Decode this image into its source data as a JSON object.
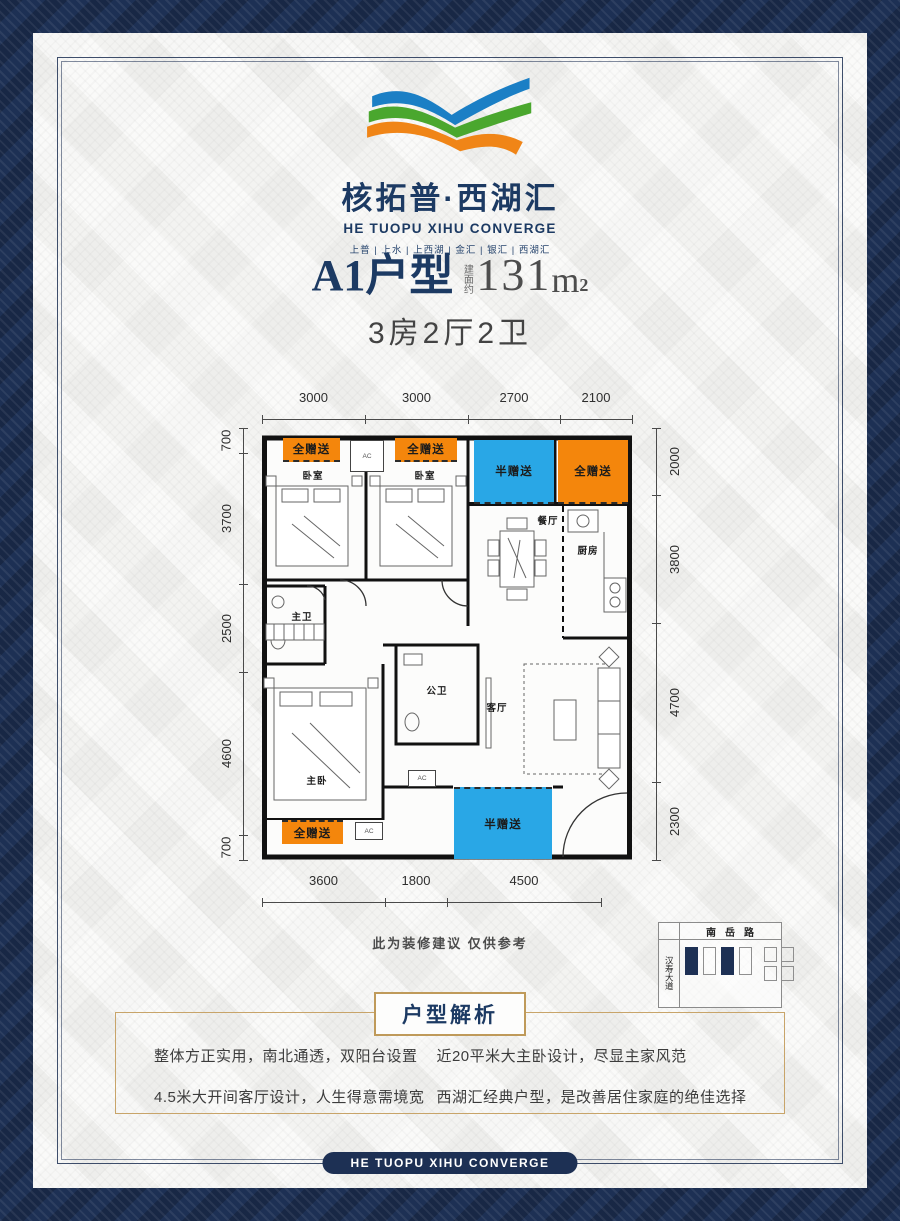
{
  "brand": {
    "title": "核拓普·西湖汇",
    "subtitle": "HE TUOPU XIHU CONVERGE",
    "tagline": "上普 | 上水 | 上西湖 | 金汇 | 银汇 | 西湖汇",
    "colors": {
      "blue": "#1b7fc5",
      "green": "#4aa72e",
      "orange": "#f08517",
      "navy": "#1d3054"
    }
  },
  "unit": {
    "name": "A1户型",
    "area_label": "建面约",
    "area_value": "131",
    "area_unit": "m",
    "area_sup": "2",
    "rooms_line": "3房2厅2卫"
  },
  "floorplan": {
    "dims_top": [
      "3000",
      "3000",
      "2700",
      "2100"
    ],
    "dims_bottom": [
      "3600",
      "1800",
      "4500"
    ],
    "dims_left": [
      "700",
      "3700",
      "2500",
      "4600",
      "700"
    ],
    "dims_right": [
      "2000",
      "3800",
      "4700",
      "2300"
    ],
    "rooms": {
      "bedroom1": "卧室",
      "bedroom2": "卧室",
      "dining": "餐厅",
      "kitchen": "厨房",
      "master_bath": "主卫",
      "public_bath": "公卫",
      "living": "客厅",
      "master_bedroom": "主卧"
    },
    "gift_full": "全赠送",
    "gift_half": "半赠送",
    "ac_label": "AC",
    "note": "此为装修建议 仅供参考",
    "colors": {
      "gift_full": "#f4860c",
      "gift_half": "#29a7e6"
    }
  },
  "minimap": {
    "road_top": "南岳路",
    "road_left": "汉寿大道"
  },
  "analysis": {
    "header": "户型解析",
    "bullets": [
      "整体方正实用，南北通透，双阳台设置",
      "4.5米大开间客厅设计，人生得意需境宽",
      "近20平米大主卧设计，尽显主家风范",
      "西湖汇经典户型，是改善居住家庭的绝佳选择"
    ]
  },
  "footer": {
    "text": "HE TUOPU XIHU CONVERGE"
  },
  "theme": {
    "navy": "#1d3054",
    "gold": "#bf9a5a"
  }
}
